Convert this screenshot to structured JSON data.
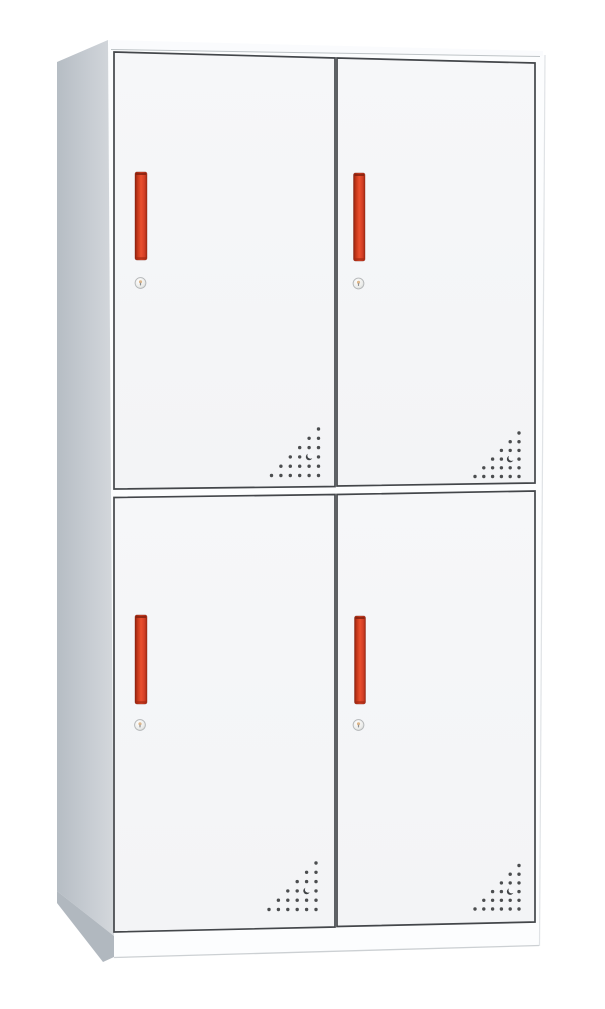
{
  "image": {
    "width": 605,
    "height": 1009,
    "background": "#ffffff"
  },
  "scene": {
    "type": "product-photo",
    "subject": "four-door steel locker storage cabinet",
    "rows": 2,
    "columns": 2,
    "door_count": 4,
    "handle_style": "vertical red recessed handle",
    "lock_style": "round cam lock below handle",
    "vent_style": "triangular perforation dot pattern with crescent hole at bottom-right corner of each door"
  },
  "palette": {
    "background": "#ffffff",
    "front_panel": "#fcfdfe",
    "top_panel": "#fafbfd",
    "side_panel_left_edge": "#b6bdc4",
    "side_panel": "#c8cdd3",
    "side_panel_light": "#d4d8dc",
    "side_panel_base": "#b1b8bf",
    "door_fill": "#f6f7f9",
    "door_fill_bottom": "#f3f4f6",
    "door_border": "#43464a",
    "handle_red_dark": "#8b2110",
    "handle_red_mid": "#c23618",
    "handle_red": "#ea4f2e",
    "handle_red_deep": "#d43f26",
    "handle_red_edge": "#a22a13",
    "handle_cap": "#7f1f0e",
    "vent_dot": "#4b4d4f",
    "vent_crescent": "#3f4245",
    "keyhole_highlight": "#ffffff",
    "keyhole_mid": "#ebecea",
    "keyhole_shadow": "#cdd0cd",
    "keyhole_ring": "#b3b6b8",
    "keyhole_brass": "#d8ac79",
    "keyhole_slot": "#8d8f91"
  },
  "cabinet": {
    "front": {
      "points": "108,44 545,55 539,946 114,958"
    },
    "top_panel": {
      "points": "108,40 543,51 543,56 111,49"
    },
    "side_panel": {
      "points": "57,62 108,40 114,936 57,891"
    },
    "side_base": {
      "points": "57,891 114,936 114,957 103,962 57,903"
    },
    "edges": {
      "top_ridge": "111,49.5 540,56.5",
      "right_silhouette": "545,55 539.5,946",
      "base_bottom": "114,957.5 539,945.5"
    },
    "door_stroke_width": 1.7,
    "doors": [
      {
        "id": "top-left",
        "face": "114,52 335,58 335,486.5 114,489",
        "handle": {
          "x": 135,
          "y": 172,
          "width": 12,
          "height": 88
        },
        "keyhole": {
          "cx": 140.5,
          "cy": 283,
          "r": 5.4
        },
        "vent": {
          "right_x": 318.5,
          "bottom_y": 475.5,
          "col_step": 9.4,
          "row_step": 9.3,
          "columns": 6,
          "crescent_col_from_right": 1,
          "crescent_row_from_bottom": 2
        }
      },
      {
        "id": "top-right",
        "face": "337,58 535,63 535,483 337,486",
        "handle": {
          "x": 353.5,
          "y": 173,
          "width": 11.5,
          "height": 88
        },
        "keyhole": {
          "cx": 358.5,
          "cy": 283.5,
          "r": 5.4
        },
        "vent": {
          "right_x": 519,
          "bottom_y": 476.5,
          "col_step": 8.8,
          "row_step": 8.7,
          "columns": 6,
          "crescent_col_from_right": 1,
          "crescent_row_from_bottom": 2
        }
      },
      {
        "id": "bottom-left",
        "face": "114,497.5 335,494.5 335,927 114,932",
        "handle": {
          "x": 135,
          "y": 615,
          "width": 12,
          "height": 89
        },
        "keyhole": {
          "cx": 140,
          "cy": 725,
          "r": 5.4
        },
        "vent": {
          "right_x": 316,
          "bottom_y": 909.5,
          "col_step": 9.4,
          "row_step": 9.3,
          "columns": 6,
          "crescent_col_from_right": 1,
          "crescent_row_from_bottom": 2
        }
      },
      {
        "id": "bottom-right",
        "face": "337,494.5 535,491 535,922 337,926.5",
        "handle": {
          "x": 354.5,
          "y": 616,
          "width": 11,
          "height": 88
        },
        "keyhole": {
          "cx": 358.5,
          "cy": 725,
          "r": 5.4
        },
        "vent": {
          "right_x": 519,
          "bottom_y": 909,
          "col_step": 8.8,
          "row_step": 8.7,
          "columns": 6,
          "crescent_col_from_right": 1,
          "crescent_row_from_bottom": 2
        }
      }
    ]
  }
}
